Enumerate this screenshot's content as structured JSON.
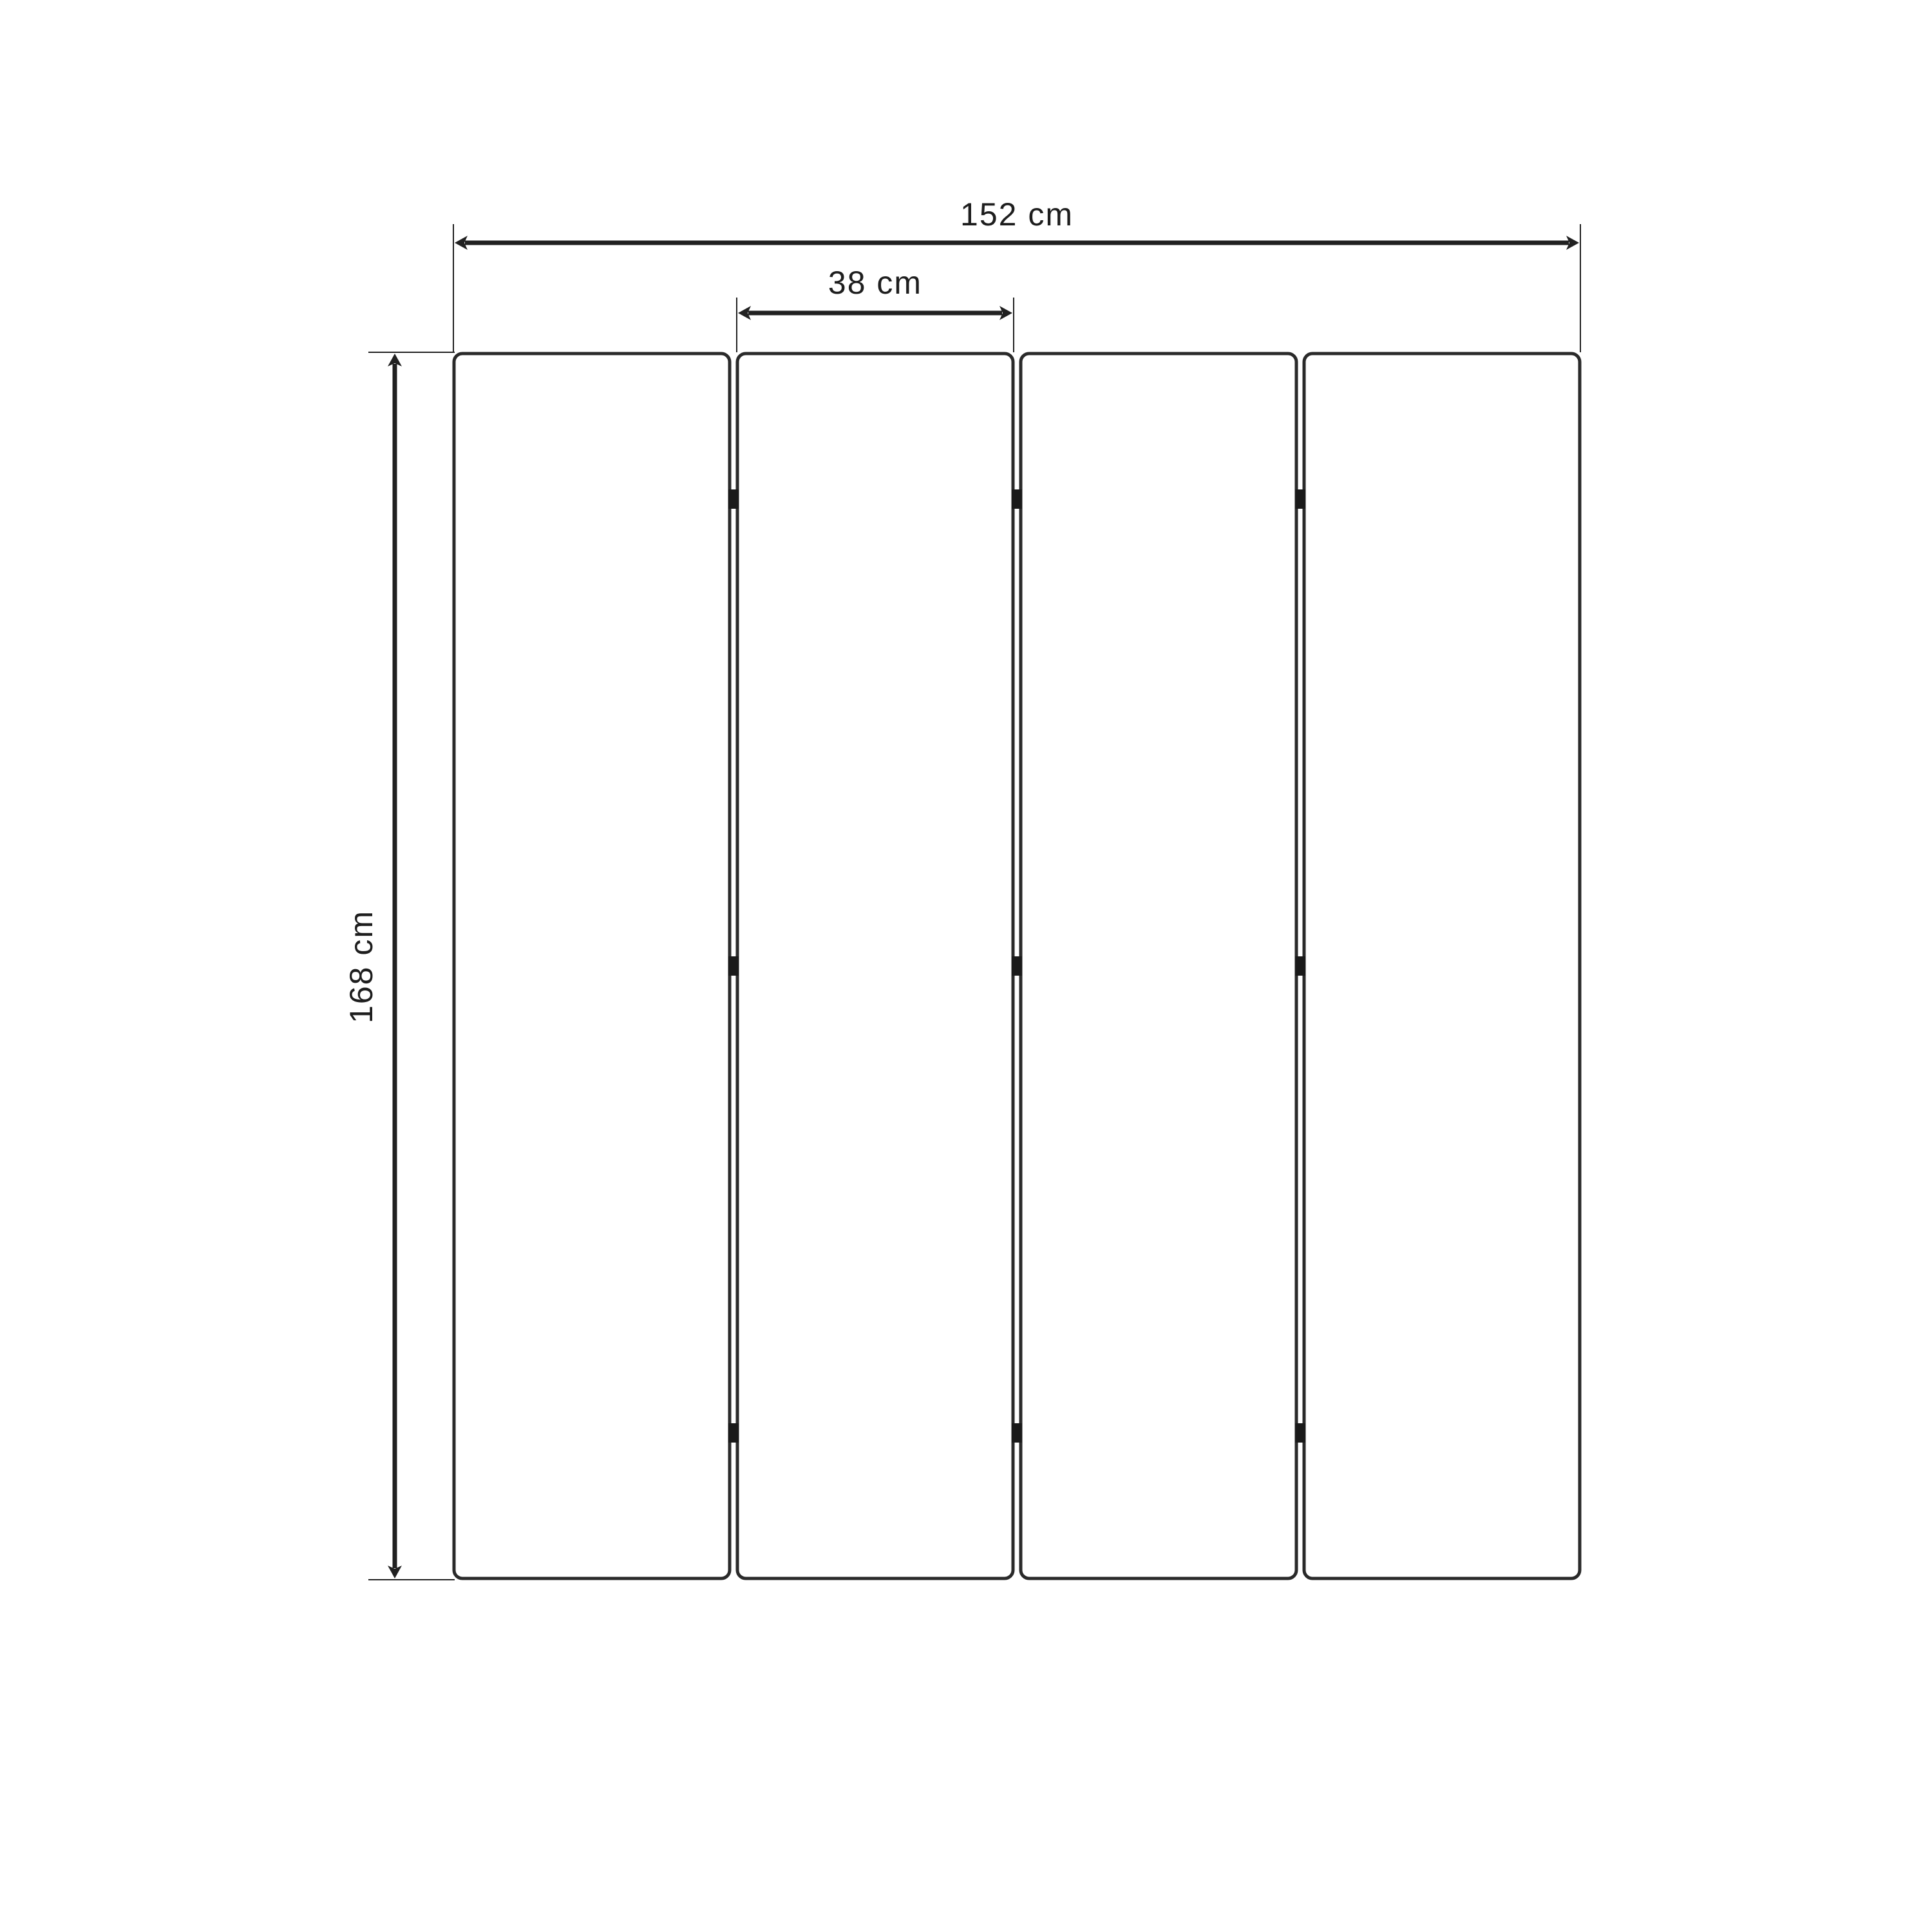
{
  "diagram": {
    "kind": "technical-dimension-drawing",
    "panel_count": 4,
    "hinge_rows_per_gap": 3,
    "labels": {
      "total_width": "152 cm",
      "panel_width": "38 cm",
      "height": "168 cm"
    },
    "values": {
      "total_width_cm": 152,
      "panel_width_cm": 38,
      "height_cm": 168
    },
    "colors": {
      "background": "#ffffff",
      "dimension_line": "#212121",
      "panel_border": "#2a2a2a",
      "hinge": "#1a1a1a",
      "text": "#1e1e1e"
    }
  }
}
